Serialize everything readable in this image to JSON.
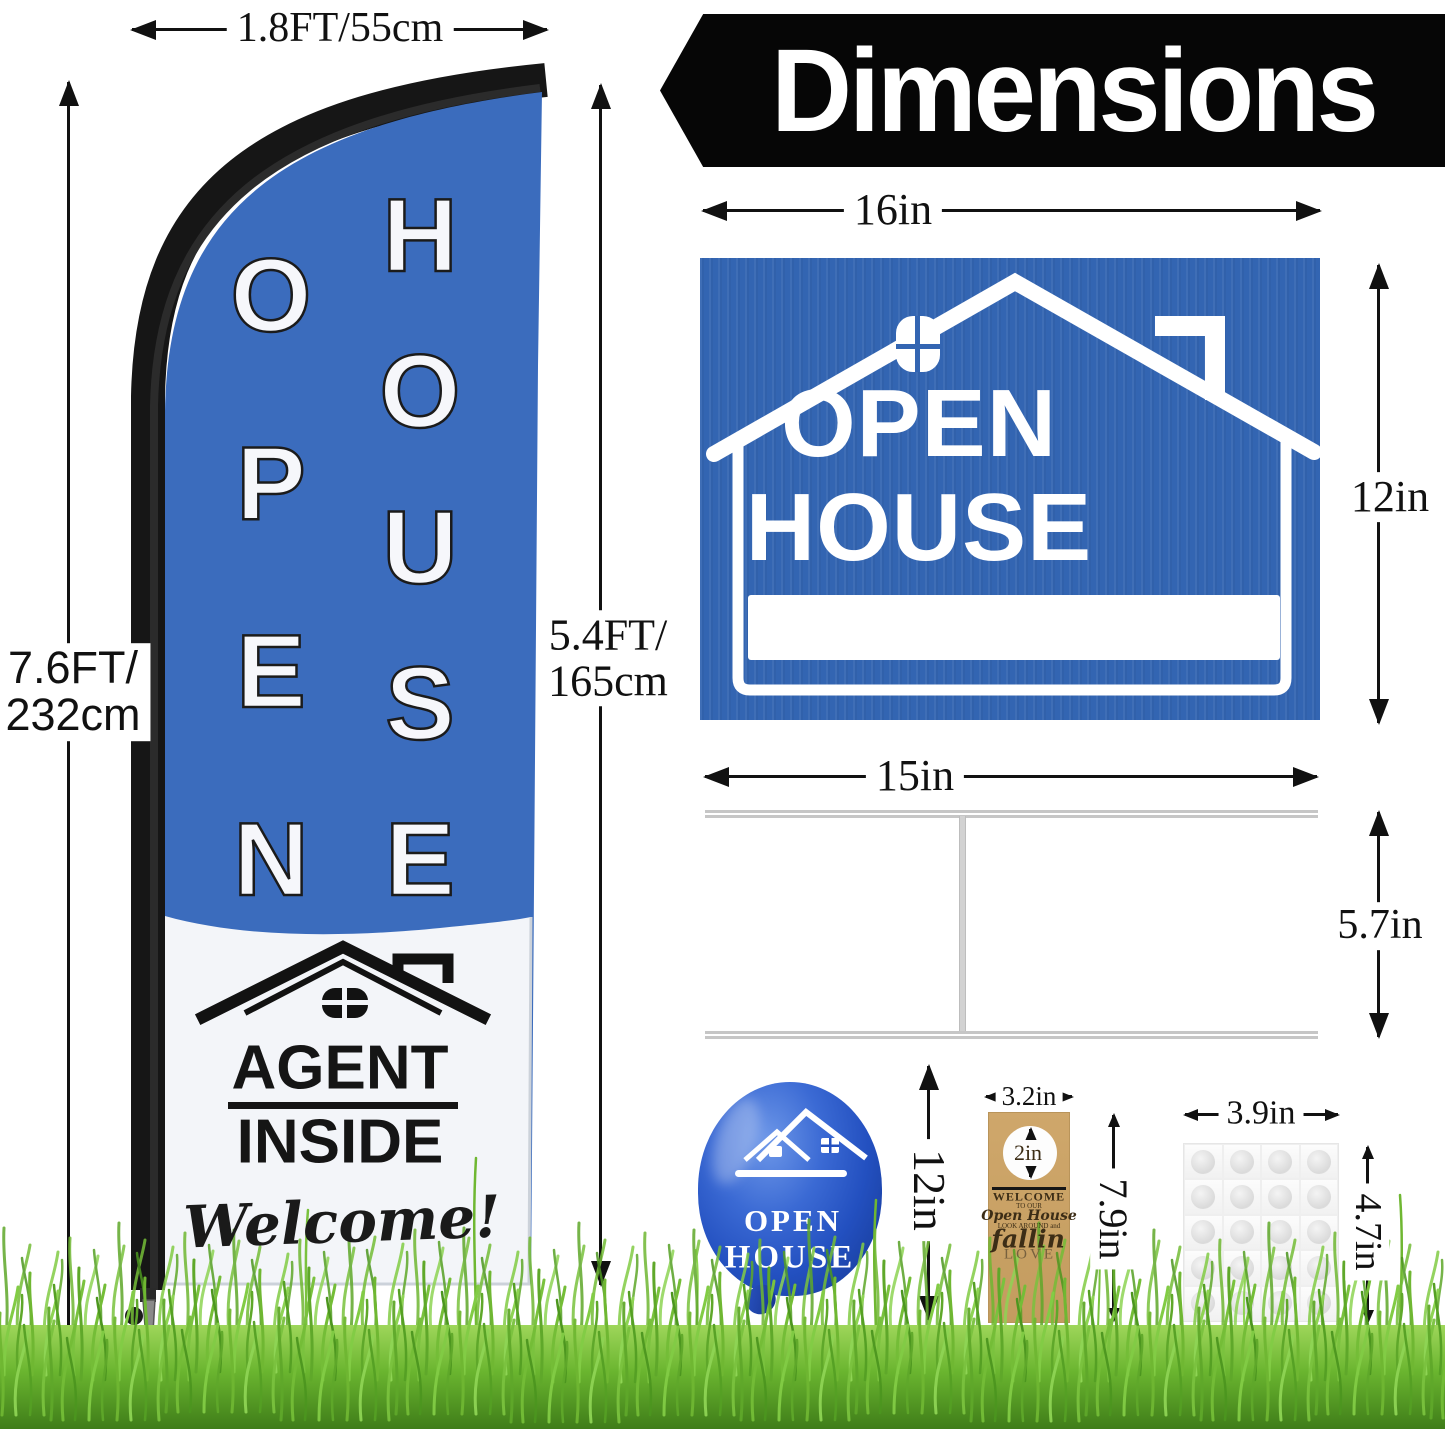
{
  "banner": {
    "title": "Dimensions"
  },
  "flag": {
    "width_label": "1.8FT/55cm",
    "pole_height_label_line1": "7.6FT/",
    "pole_height_label_line2": "232cm",
    "flag_height_label_line1": "5.4FT/",
    "flag_height_label_line2": "165cm",
    "word_open": "OPEN",
    "word_house": "HOUSE",
    "agent_word1": "AGENT",
    "agent_word2": "INSIDE",
    "welcome_script": "Welcome!"
  },
  "yard_sign": {
    "width_label": "16in",
    "height_label": "12in",
    "line1": "OPEN",
    "line2": "HOUSE"
  },
  "h_stake": {
    "width_label": "15in",
    "height_label": "5.7in"
  },
  "balloon": {
    "height_label": "12in",
    "line1": "OPEN",
    "line2": "HOUSE"
  },
  "door_hanger": {
    "width_label": "3.2in",
    "sticker_label": "2in",
    "height_label": "7.9in",
    "text_line1": "WELCOME",
    "text_line2": "TO OUR",
    "text_line3": "Open House",
    "text_line4": "LOOK AROUND and",
    "text_line5": "fallin",
    "text_line6": "LOVE"
  },
  "adhesive_sheet": {
    "width_label": "3.9in",
    "height_label": "4.7in"
  },
  "colors": {
    "sign_blue": "#3365b2",
    "flag_blue": "#3b6cbd",
    "balloon_blue": "#2350c0",
    "kraft": "#c9a368",
    "banner_black": "#060606",
    "grass_green": "#5aa82c"
  }
}
